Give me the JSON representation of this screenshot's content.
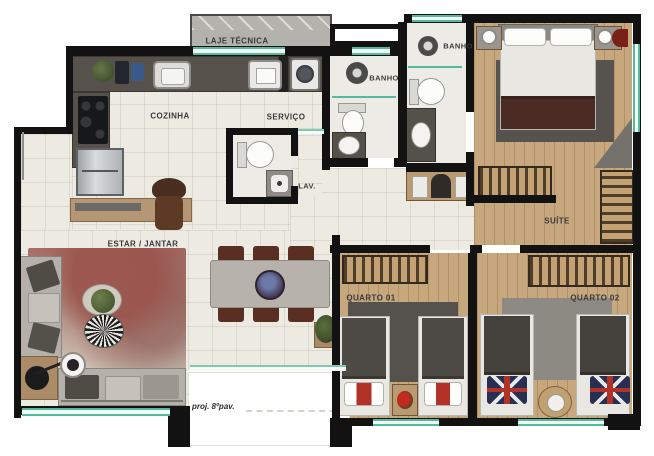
{
  "meta": {
    "type": "apartment floor plan",
    "width_px": 654,
    "height_px": 456
  },
  "rooms": {
    "laje_tecnica": {
      "label": "LAJE TÉCNICA"
    },
    "cozinha": {
      "label": "COZINHA"
    },
    "servico": {
      "label": "SERVIÇO"
    },
    "lav": {
      "label": "LAV."
    },
    "banho_social": {
      "label": "BANHO"
    },
    "banho_suite": {
      "label": "BANHO"
    },
    "suite": {
      "label": "SUÍTE"
    },
    "estar_jantar": {
      "label": "ESTAR / JANTAR"
    },
    "quarto_01": {
      "label": "QUARTO 01"
    },
    "quarto_02": {
      "label": "QUARTO 02"
    }
  },
  "annotations": {
    "projection_note": "proj. 8ºpav."
  },
  "colors": {
    "wall": "#121212",
    "window_glass": "#56b89d",
    "tile_floor": "#edeae2",
    "wood_floor": "#c7a77d",
    "counter": "#56514b",
    "laje_slab": "#b4b2ad",
    "suite_blanket": "#4a2c25",
    "living_rug": "#9b564e"
  }
}
